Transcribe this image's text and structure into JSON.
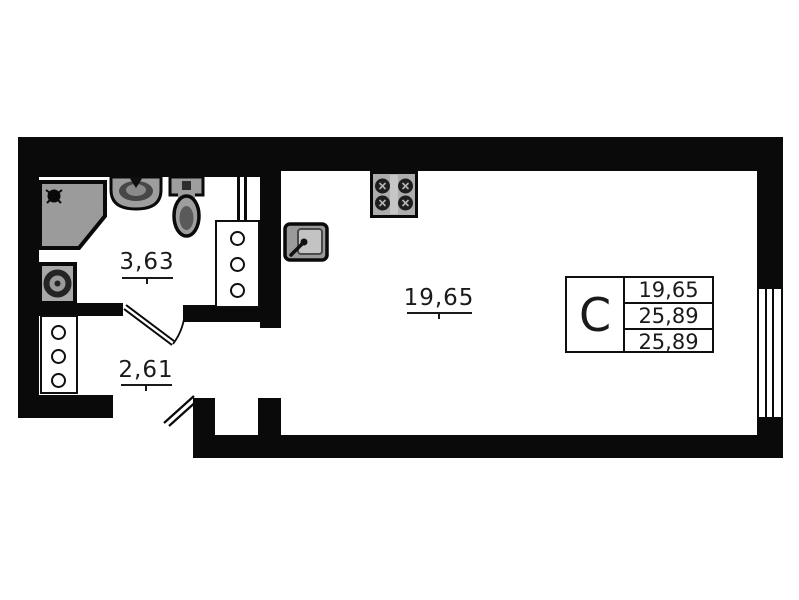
{
  "floor_plan": {
    "title": "Studio apartment floor plan",
    "room_labels": {
      "bathroom": "3,63",
      "hallway": "2,61",
      "living_room": "19,65"
    },
    "legend": {
      "type": "C",
      "rows": [
        "19,65",
        "25,89",
        "25,89"
      ]
    },
    "symbols": [
      "shower",
      "shower-head",
      "washing-machine",
      "bathroom-sink",
      "toilet",
      "riser-shaft-bathroom",
      "riser-shaft-hallway",
      "kitchen-stove",
      "kitchen-sink",
      "window",
      "bathroom-door-swing",
      "entrance-door-swing"
    ],
    "colors": {
      "wall": "#0a0a0a",
      "fixture_fill": "#9e9e9e",
      "fixture_dark": "#2e2e2e",
      "paper": "#ffffff"
    }
  }
}
